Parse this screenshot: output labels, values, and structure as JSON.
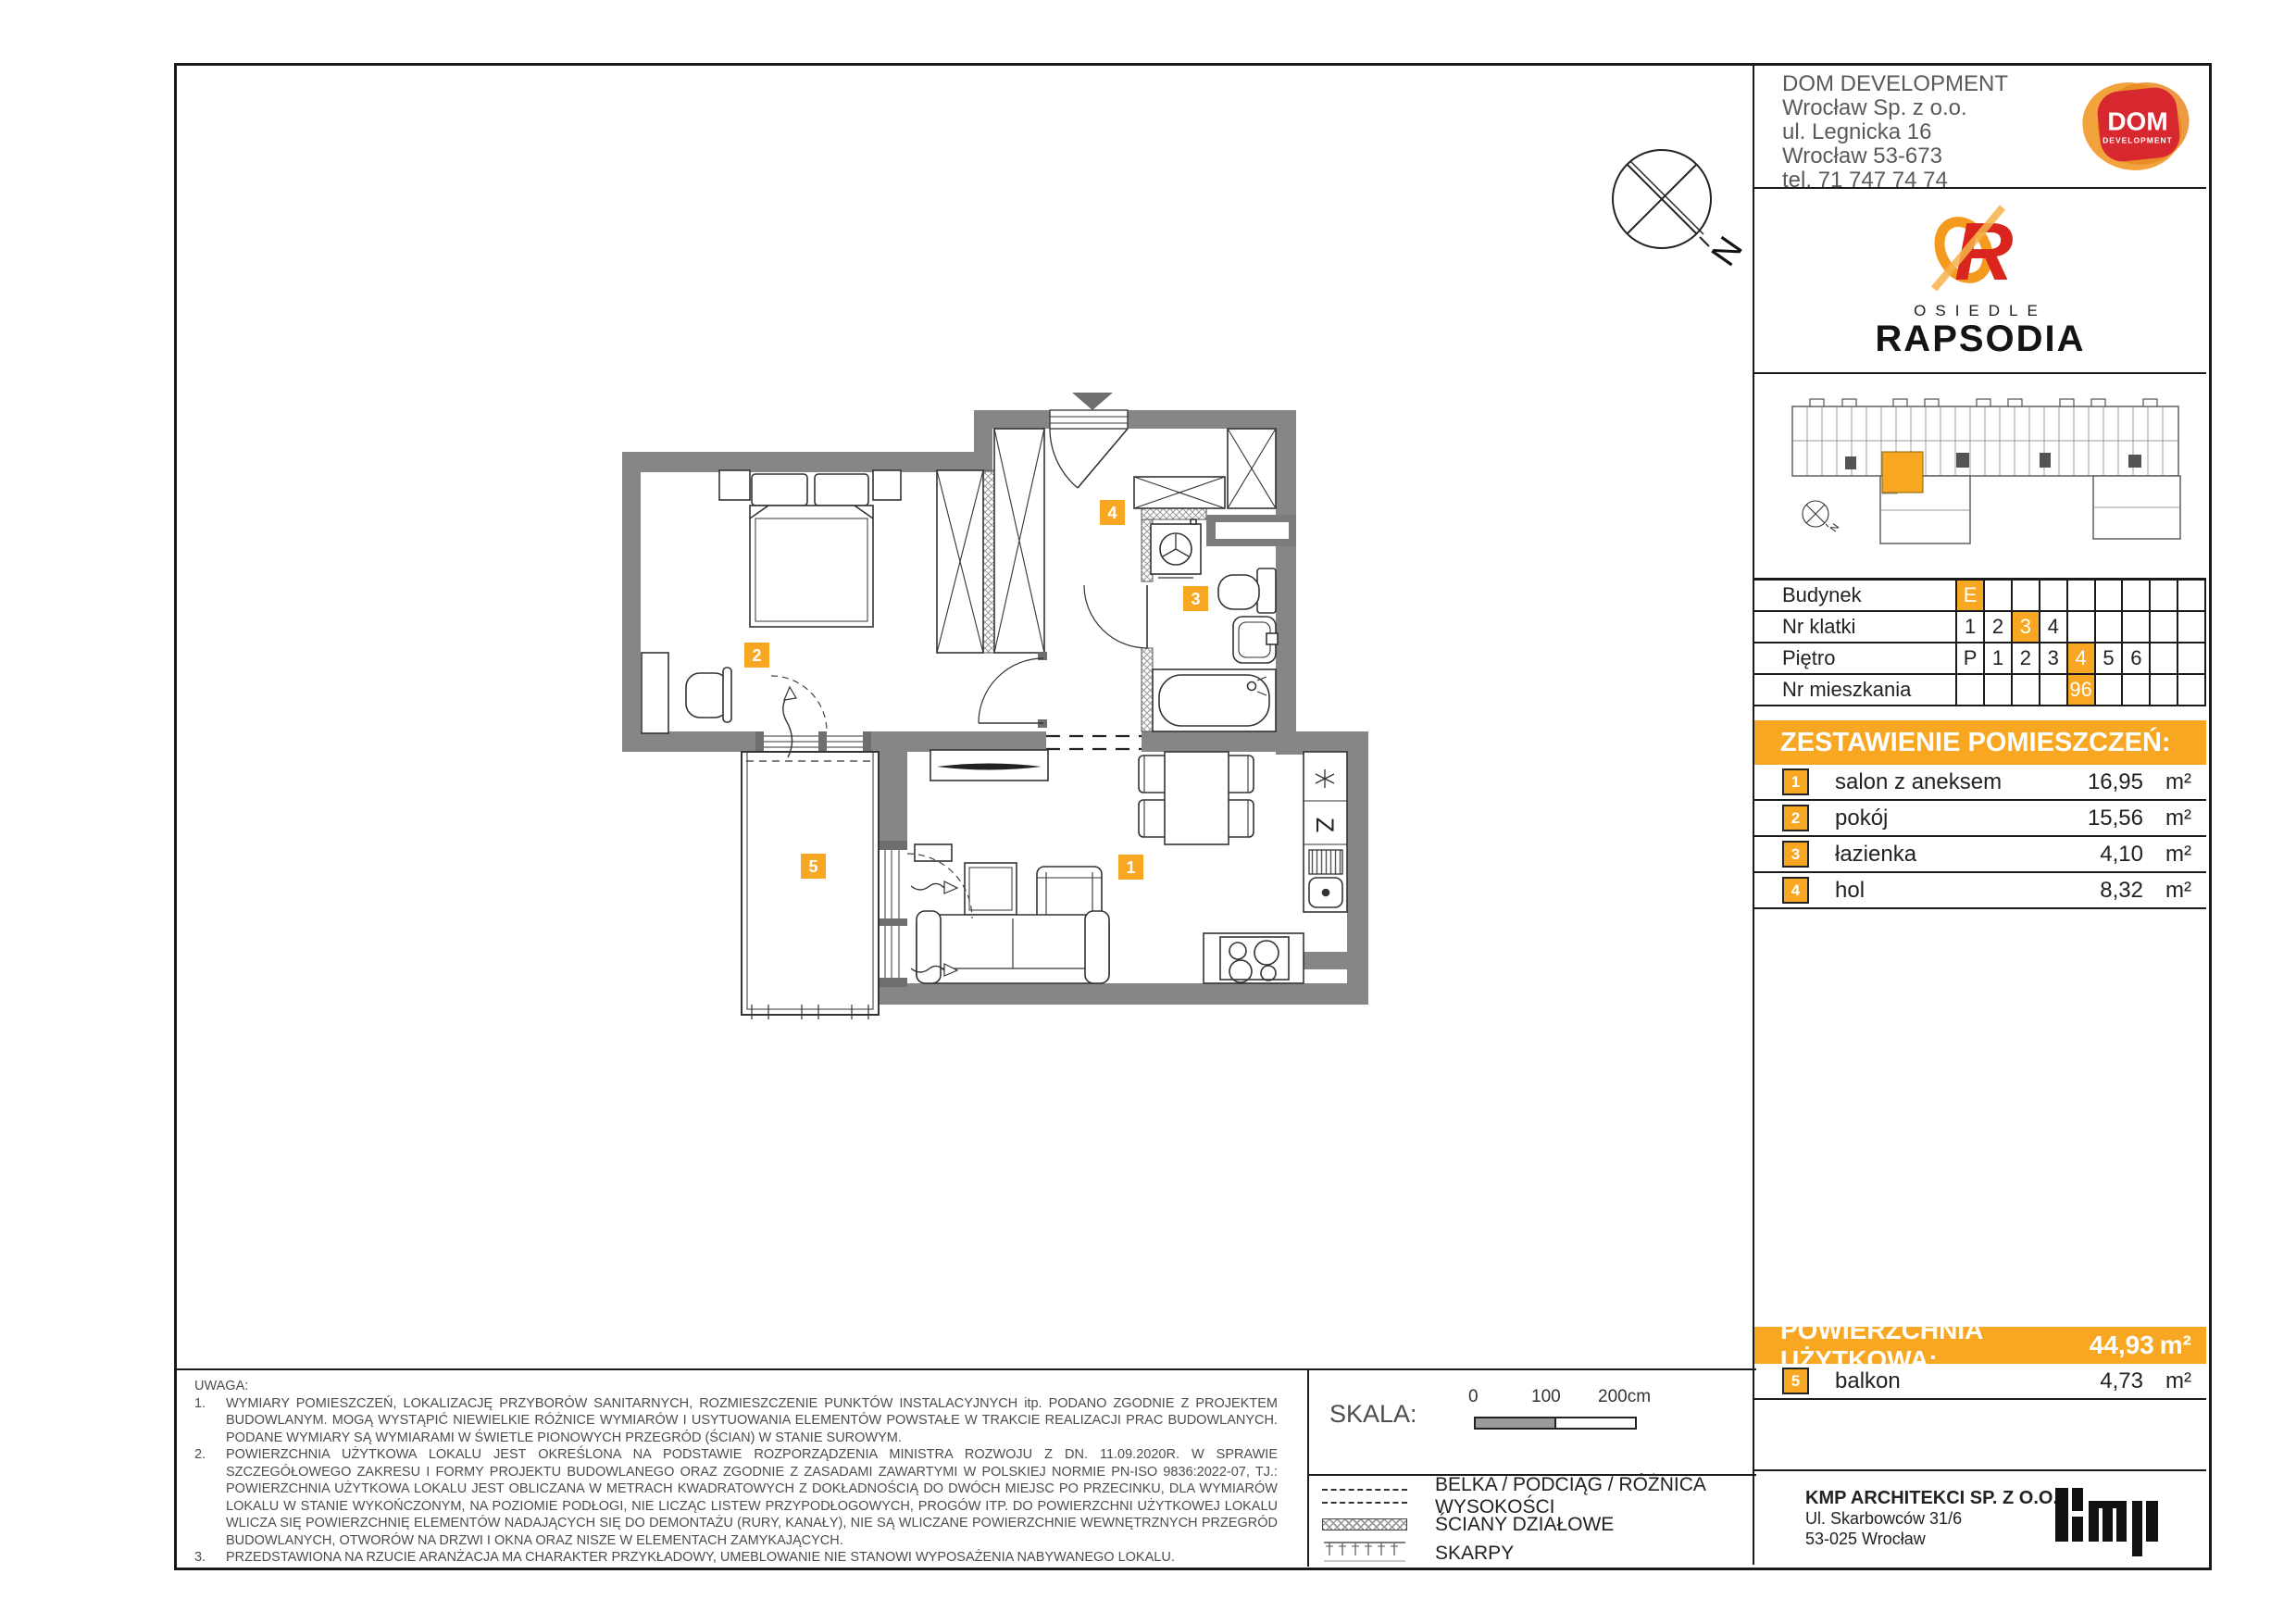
{
  "company": {
    "name": "DOM DEVELOPMENT",
    "lines": [
      "Wrocław Sp. z o.o.",
      "ul. Legnicka 16",
      "Wrocław 53-673",
      "tel. 71 747 74 74"
    ],
    "logo": {
      "title": "DOM",
      "subtitle": "DEVELOPMENT"
    }
  },
  "estate": {
    "kicker": "OSIEDLE",
    "name": "RAPSODIA",
    "monogram": "R"
  },
  "unit_table": {
    "rows": [
      {
        "label": "Budynek",
        "cells": [
          "E",
          "",
          "",
          "",
          "",
          "",
          "",
          "",
          ""
        ],
        "highlight": 0
      },
      {
        "label": "Nr klatki",
        "cells": [
          "1",
          "2",
          "3",
          "4",
          "",
          "",
          "",
          "",
          ""
        ],
        "highlight": 2
      },
      {
        "label": "Piętro",
        "cells": [
          "P",
          "1",
          "2",
          "3",
          "4",
          "5",
          "6",
          "",
          ""
        ],
        "highlight": 4
      },
      {
        "label": "Nr mieszkania",
        "cells": [
          "",
          "",
          "",
          "",
          "96",
          "",
          "",
          "",
          ""
        ],
        "highlight": 4
      }
    ]
  },
  "rooms": {
    "header": "ZESTAWIENIE POMIESZCZEŃ:",
    "items": [
      {
        "no": "1",
        "name": "salon z aneksem",
        "area": "16,95",
        "unit": "m²"
      },
      {
        "no": "2",
        "name": "pokój",
        "area": "15,56",
        "unit": "m²"
      },
      {
        "no": "3",
        "name": "łazienka",
        "area": "4,10",
        "unit": "m²"
      },
      {
        "no": "4",
        "name": "hol",
        "area": "8,32",
        "unit": "m²"
      }
    ]
  },
  "total": {
    "label": "POWIERZCHNIA UŻYTKOWA:",
    "value": "44,93",
    "unit": "m²"
  },
  "balcony_row": {
    "no": "5",
    "name": "balkon",
    "area": "4,73",
    "unit": "m²"
  },
  "architect": {
    "name": "KMP ARCHITEKCI SP. Z O.O.",
    "lines": [
      "Ul. Skarbowców 31/6",
      "53-025 Wrocław"
    ],
    "logo": "kmp"
  },
  "notes": {
    "title": "UWAGA:",
    "items": [
      "WYMIARY POMIESZCZEŃ, LOKALIZACJĘ PRZYBORÓW SANITARNYCH, ROZMIESZCZENIE PUNKTÓW INSTALACYJNYCH itp. PODANO ZGODNIE Z PROJEKTEM BUDOWLANYM. MOGĄ WYSTĄPIĆ NIEWIELKIE RÓŻNICE WYMIARÓW I USYTUOWANIA ELEMENTÓW POWSTAŁE W TRAKCIE REALIZACJI PRAC BUDOWLANYCH. PODANE WYMIARY SĄ WYMIARAMI W ŚWIETLE PIONOWYCH PRZEGRÓD (ŚCIAN) W STANIE SUROWYM.",
      "POWIERZCHNIA UŻYTKOWA LOKALU JEST OKREŚLONA NA PODSTAWIE ROZPORZĄDZENIA MINISTRA ROZWOJU Z DN. 11.09.2020R. W SPRAWIE SZCZEGÓŁOWEGO ZAKRESU I FORMY PROJEKTU BUDOWLANEGO ORAZ ZGODNIE Z ZASADAMI ZAWARTYMI W POLSKIEJ NORMIE PN-ISO 9836:2022-07, TJ.: POWIERZCHNIA UŻYTKOWA LOKALU JEST OBLICZANA W METRACH KWADRATOWYCH Z DOKŁADNOŚCIĄ DO DWÓCH MIEJSC PO PRZECINKU, DLA WYMIARÓW LOKALU W STANIE WYKOŃCZONYM, NA POZIOMIE PODŁOGI, NIE LICZĄC LISTEW PRZYPODŁOGOWYCH, PROGÓW ITP. DO POWIERZCHNI UŻYTKOWEJ LOKALU WLICZA SIĘ POWIERZCHNIĘ ELEMENTÓW NADAJĄCYCH SIĘ DO DEMONTAŻU (RURY, KANAŁY), NIE SĄ WLICZANE POWIERZCHNIE WEWNĘTRZNYCH PRZEGRÓD BUDOWLANYCH, OTWORÓW NA DRZWI I OKNA ORAZ NISZE W ELEMENTACH ZAMYKAJĄCYCH.",
      "PRZEDSTAWIONA NA RZUCIE ARANŻACJA MA CHARAKTER PRZYKŁADOWY, UMEBLOWANIE NIE STANOWI WYPOSAŻENIA NABYWANEGO LOKALU."
    ]
  },
  "scale": {
    "label": "SKALA:",
    "ticks": [
      "0",
      "100",
      "200cm"
    ]
  },
  "legend": {
    "items": [
      {
        "symbol": "beam",
        "label": "BELKA / PODCIĄG / RÓŻNICA WYSOKOŚCI"
      },
      {
        "symbol": "partition",
        "label": "ŚCIANY DZIAŁOWE"
      },
      {
        "symbol": "slope",
        "label": "SKARPY"
      }
    ]
  },
  "plan": {
    "badges": [
      "1",
      "2",
      "3",
      "4",
      "5"
    ],
    "compass": "N",
    "kitchen_letter": "Z"
  },
  "colors": {
    "accent": "#F7A721",
    "wall": "#868686",
    "red": "#D7282F"
  }
}
